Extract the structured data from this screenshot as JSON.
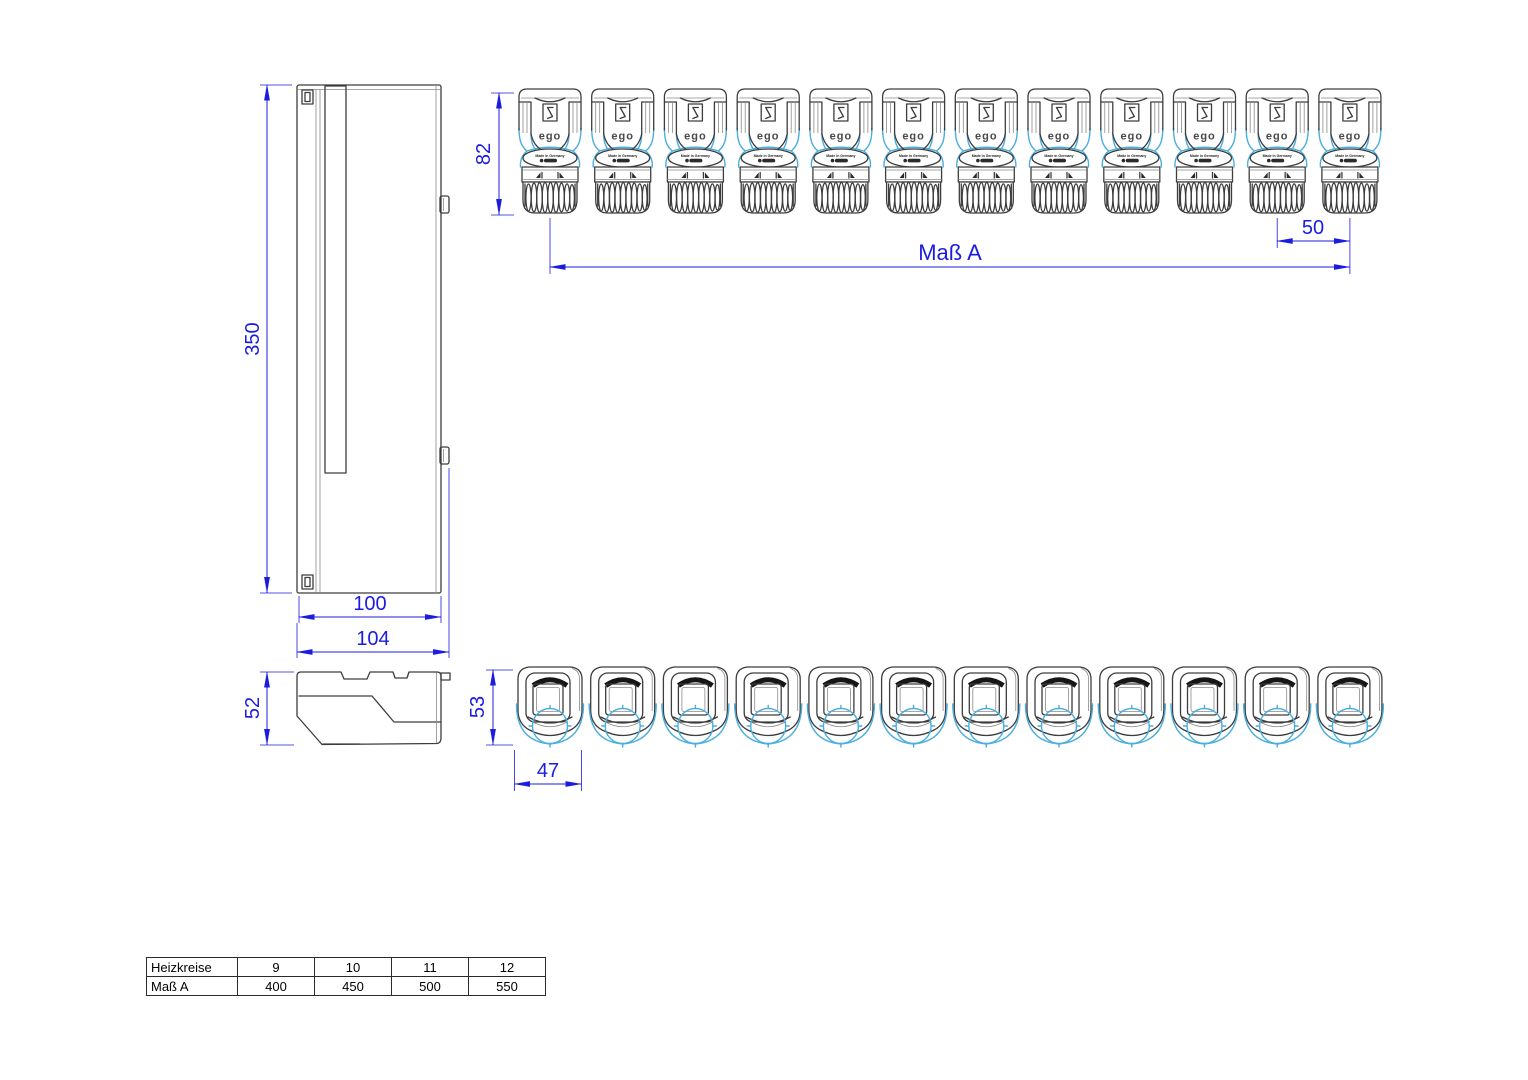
{
  "colors": {
    "dimension_blue": "#1c1ce0",
    "outline_dark": "#3d3d3d",
    "accent_cyan": "#4aaede"
  },
  "dimensions": {
    "enclosure_height": "350",
    "enclosure_width": "100",
    "enclosure_width_total": "104",
    "enclosure_depth": "52",
    "actuator_height": "82",
    "actuator_pitch": "50",
    "overall_width_label": "Maß A",
    "actuator_top_depth": "53",
    "actuator_top_width": "47"
  },
  "actuators": {
    "count": 12,
    "logo_text": "ego",
    "made_in_text": "Made in Germany"
  },
  "table": {
    "rows": [
      {
        "label": "Heizkreise",
        "values": [
          "9",
          "10",
          "11",
          "12"
        ]
      },
      {
        "label": "Maß A",
        "values": [
          "400",
          "450",
          "500",
          "550"
        ]
      }
    ]
  }
}
